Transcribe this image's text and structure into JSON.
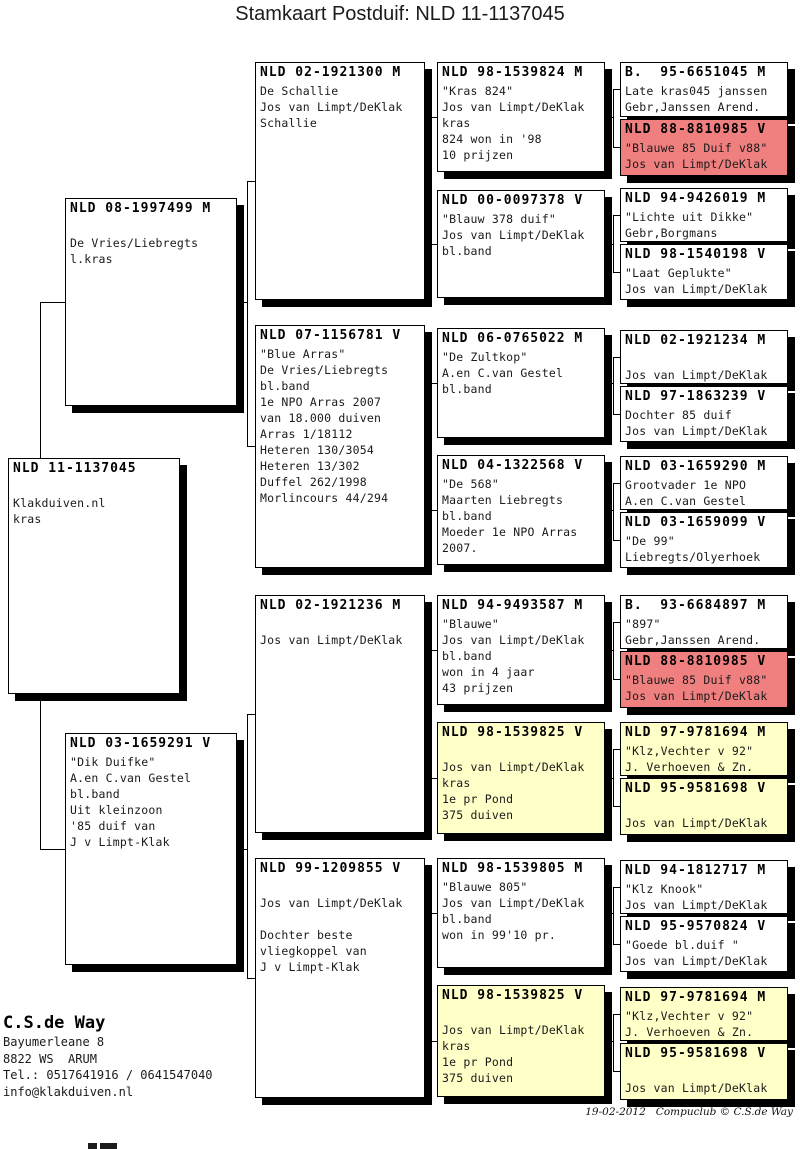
{
  "title": "Stamkaart Postduif: NLD 11-1137045",
  "colors": {
    "white": "#FFFFFF",
    "pink": "#F08080",
    "yellow": "#FFFFC8"
  },
  "footer": {
    "owner_name": "C.S.de Way",
    "address_line1": "Bayumerleane 8",
    "address_line2": "8822 WS  ARUM",
    "phone": "Tel.: 0517641916 / 0641547040",
    "email": "info@klakduiven.nl",
    "print_info": "19-02-2012   Compuclub © C.S.de Way"
  },
  "boxes": [
    {
      "id": "subject",
      "generation": 1,
      "ring": "NLD 11-1137045",
      "color": "white",
      "lines": [
        "",
        "Klakduiven.nl",
        "kras"
      ],
      "x": 8,
      "y": 458,
      "w": 172,
      "h": 236
    },
    {
      "id": "sire",
      "generation": 2,
      "ring": "NLD 08-1997499 M",
      "color": "white",
      "lines": [
        "",
        "De Vries/Liebregts",
        "l.kras"
      ],
      "x": 65,
      "y": 198,
      "w": 172,
      "h": 208
    },
    {
      "id": "dam",
      "generation": 2,
      "ring": "NLD 03-1659291 V",
      "color": "white",
      "lines": [
        "\"Dik Duifke\"",
        "A.en C.van Gestel",
        "bl.band",
        "Uit kleinzoon",
        "'85 duif van",
        "J v Limpt-Klak"
      ],
      "x": 65,
      "y": 733,
      "w": 172,
      "h": 232
    },
    {
      "id": "ss",
      "generation": 3,
      "ring": "NLD 02-1921300 M",
      "color": "white",
      "lines": [
        "De Schallie",
        "Jos van Limpt/DeKlak",
        "Schallie"
      ],
      "x": 255,
      "y": 62,
      "w": 170,
      "h": 238
    },
    {
      "id": "sd",
      "generation": 3,
      "ring": "NLD 07-1156781 V",
      "color": "white",
      "lines": [
        "\"Blue Arras\"",
        "De Vries/Liebregts",
        "bl.band",
        "1e NPO Arras 2007",
        "van 18.000 duiven",
        "Arras 1/18112",
        "Heteren 130/3054",
        "Heteren 13/302",
        "Duffel 262/1998",
        "Morlincours 44/294"
      ],
      "x": 255,
      "y": 325,
      "w": 170,
      "h": 243
    },
    {
      "id": "ds",
      "generation": 3,
      "ring": "NLD 02-1921236 M",
      "color": "white",
      "lines": [
        "",
        "Jos van Limpt/DeKlak"
      ],
      "x": 255,
      "y": 595,
      "w": 170,
      "h": 238
    },
    {
      "id": "dd",
      "generation": 3,
      "ring": "NLD 99-1209855 V",
      "color": "white",
      "lines": [
        "",
        "Jos van Limpt/DeKlak",
        "",
        "Dochter beste",
        "vliegkoppel van",
        "J v Limpt-Klak"
      ],
      "x": 255,
      "y": 858,
      "w": 170,
      "h": 240
    },
    {
      "id": "sss",
      "generation": 4,
      "ring": "NLD 98-1539824 M",
      "color": "white",
      "lines": [
        "\"Kras 824\"",
        "Jos van Limpt/DeKlak",
        "kras",
        "824 won in '98",
        "10 prijzen"
      ],
      "x": 437,
      "y": 62,
      "w": 168,
      "h": 110
    },
    {
      "id": "ssd",
      "generation": 4,
      "ring": "NLD 00-0097378 V",
      "color": "white",
      "lines": [
        "\"Blauw 378 duif\"",
        "Jos van Limpt/DeKlak",
        "bl.band"
      ],
      "x": 437,
      "y": 190,
      "w": 168,
      "h": 108
    },
    {
      "id": "sds",
      "generation": 4,
      "ring": "NLD 06-0765022 M",
      "color": "white",
      "lines": [
        "\"De Zultkop\"",
        "A.en C.van Gestel",
        "bl.band"
      ],
      "x": 437,
      "y": 328,
      "w": 168,
      "h": 110
    },
    {
      "id": "sdd",
      "generation": 4,
      "ring": "NLD 04-1322568 V",
      "color": "white",
      "lines": [
        "\"De 568\"",
        "Maarten Liebregts",
        "bl.band",
        "Moeder 1e NPO Arras",
        "2007."
      ],
      "x": 437,
      "y": 455,
      "w": 168,
      "h": 110
    },
    {
      "id": "dss",
      "generation": 4,
      "ring": "NLD 94-9493587 M",
      "color": "white",
      "lines": [
        "\"Blauwe\"",
        "Jos van Limpt/DeKlak",
        "bl.band",
        "won in 4 jaar",
        "43 prijzen"
      ],
      "x": 437,
      "y": 595,
      "w": 168,
      "h": 110
    },
    {
      "id": "dsd",
      "generation": 4,
      "ring": "NLD 98-1539825 V",
      "color": "yellow",
      "lines": [
        "",
        "Jos van Limpt/DeKlak",
        "kras",
        "1e pr Pond",
        "375 duiven"
      ],
      "x": 437,
      "y": 722,
      "w": 168,
      "h": 112
    },
    {
      "id": "dds",
      "generation": 4,
      "ring": "NLD 98-1539805 M",
      "color": "white",
      "lines": [
        "\"Blauwe 805\"",
        "Jos van Limpt/DeKlak",
        "bl.band",
        "won in 99'10 pr."
      ],
      "x": 437,
      "y": 858,
      "w": 168,
      "h": 110
    },
    {
      "id": "ddd",
      "generation": 4,
      "ring": "NLD 98-1539825 V",
      "color": "yellow",
      "lines": [
        "",
        "Jos van Limpt/DeKlak",
        "kras",
        "1e pr Pond",
        "375 duiven"
      ],
      "x": 437,
      "y": 985,
      "w": 168,
      "h": 112
    },
    {
      "id": "sss-s",
      "generation": 5,
      "ring": "B.  95-6651045 M",
      "color": "white",
      "lines": [
        "Late kras045 janssen",
        "Gebr,Janssen Arend."
      ],
      "x": 620,
      "y": 62,
      "w": 168,
      "h": 55
    },
    {
      "id": "sss-d",
      "generation": 5,
      "ring": "NLD 88-8810985 V",
      "color": "pink",
      "lines": [
        "\"Blauwe 85 Duif v88\"",
        "Jos van Limpt/DeKlak"
      ],
      "x": 620,
      "y": 119,
      "w": 168,
      "h": 57
    },
    {
      "id": "ssd-s",
      "generation": 5,
      "ring": "NLD 94-9426019 M",
      "color": "white",
      "lines": [
        "\"Lichte uit Dikke\"",
        "Gebr,Borgmans"
      ],
      "x": 620,
      "y": 188,
      "w": 168,
      "h": 54
    },
    {
      "id": "ssd-d",
      "generation": 5,
      "ring": "NLD 98-1540198 V",
      "color": "white",
      "lines": [
        "\"Laat Geplukte\"",
        "Jos van Limpt/DeKlak"
      ],
      "x": 620,
      "y": 244,
      "w": 168,
      "h": 56
    },
    {
      "id": "sds-s",
      "generation": 5,
      "ring": "NLD 02-1921234 M",
      "color": "white",
      "lines": [
        "",
        "Jos van Limpt/DeKlak"
      ],
      "x": 620,
      "y": 330,
      "w": 168,
      "h": 54
    },
    {
      "id": "sds-d",
      "generation": 5,
      "ring": "NLD 97-1863239 V",
      "color": "white",
      "lines": [
        "Dochter 85 duif",
        "Jos van Limpt/DeKlak"
      ],
      "x": 620,
      "y": 386,
      "w": 168,
      "h": 56
    },
    {
      "id": "sdd-s",
      "generation": 5,
      "ring": "NLD 03-1659290 M",
      "color": "white",
      "lines": [
        "Grootvader 1e NPO",
        "A.en C.van Gestel"
      ],
      "x": 620,
      "y": 456,
      "w": 168,
      "h": 54
    },
    {
      "id": "sdd-d",
      "generation": 5,
      "ring": "NLD 03-1659099 V",
      "color": "white",
      "lines": [
        "\"De 99\"",
        "Liebregts/Olyerhoek"
      ],
      "x": 620,
      "y": 512,
      "w": 168,
      "h": 56
    },
    {
      "id": "dss-s",
      "generation": 5,
      "ring": "B.  93-6684897 M",
      "color": "white",
      "lines": [
        "\"897\"",
        "Gebr,Janssen Arend."
      ],
      "x": 620,
      "y": 595,
      "w": 168,
      "h": 54
    },
    {
      "id": "dss-d",
      "generation": 5,
      "ring": "NLD 88-8810985 V",
      "color": "pink",
      "lines": [
        "\"Blauwe 85 Duif v88\"",
        "Jos van Limpt/DeKlak"
      ],
      "x": 620,
      "y": 651,
      "w": 168,
      "h": 57
    },
    {
      "id": "dsd-s",
      "generation": 5,
      "ring": "NLD 97-9781694 M",
      "color": "yellow",
      "lines": [
        "\"Klz,Vechter v 92\"",
        "J. Verhoeven & Zn."
      ],
      "x": 620,
      "y": 722,
      "w": 168,
      "h": 54
    },
    {
      "id": "dsd-d",
      "generation": 5,
      "ring": "NLD 95-9581698 V",
      "color": "yellow",
      "lines": [
        "",
        "Jos van Limpt/DeKlak"
      ],
      "x": 620,
      "y": 778,
      "w": 168,
      "h": 57
    },
    {
      "id": "dds-s",
      "generation": 5,
      "ring": "NLD 94-1812717 M",
      "color": "white",
      "lines": [
        "\"Klz Knook\"",
        "Jos van Limpt/DeKlak"
      ],
      "x": 620,
      "y": 860,
      "w": 168,
      "h": 54
    },
    {
      "id": "dds-d",
      "generation": 5,
      "ring": "NLD 95-9570824 V",
      "color": "white",
      "lines": [
        "\"Goede bl.duif \"",
        "Jos van Limpt/DeKlak"
      ],
      "x": 620,
      "y": 916,
      "w": 168,
      "h": 56
    },
    {
      "id": "ddd-s",
      "generation": 5,
      "ring": "NLD 97-9781694 M",
      "color": "yellow",
      "lines": [
        "\"Klz,Vechter v 92\"",
        "J. Verhoeven & Zn."
      ],
      "x": 620,
      "y": 987,
      "w": 168,
      "h": 54
    },
    {
      "id": "ddd-d",
      "generation": 5,
      "ring": "NLD 95-9581698 V",
      "color": "yellow",
      "lines": [
        "",
        "Jos van Limpt/DeKlak"
      ],
      "x": 620,
      "y": 1043,
      "w": 168,
      "h": 57
    }
  ],
  "connectors": [
    {
      "o": "v",
      "x": 40,
      "y": 302,
      "l": 547
    },
    {
      "o": "h",
      "x": 40,
      "y": 302,
      "l": 25
    },
    {
      "o": "h",
      "x": 40,
      "y": 849,
      "l": 25
    },
    {
      "o": "v",
      "x": 247,
      "y": 181,
      "l": 265
    },
    {
      "o": "h",
      "x": 247,
      "y": 181,
      "l": 8
    },
    {
      "o": "h",
      "x": 247,
      "y": 446,
      "l": 8
    },
    {
      "o": "h",
      "x": 237,
      "y": 302,
      "l": 10
    },
    {
      "o": "v",
      "x": 247,
      "y": 714,
      "l": 264
    },
    {
      "o": "h",
      "x": 247,
      "y": 714,
      "l": 8
    },
    {
      "o": "h",
      "x": 247,
      "y": 978,
      "l": 8
    },
    {
      "o": "h",
      "x": 237,
      "y": 849,
      "l": 10
    },
    {
      "o": "v",
      "x": 430,
      "y": 117,
      "l": 127
    },
    {
      "o": "h",
      "x": 430,
      "y": 117,
      "l": 7
    },
    {
      "o": "h",
      "x": 430,
      "y": 244,
      "l": 7
    },
    {
      "o": "h",
      "x": 425,
      "y": 181,
      "l": 5
    },
    {
      "o": "v",
      "x": 430,
      "y": 383,
      "l": 127
    },
    {
      "o": "h",
      "x": 430,
      "y": 383,
      "l": 7
    },
    {
      "o": "h",
      "x": 430,
      "y": 510,
      "l": 7
    },
    {
      "o": "h",
      "x": 425,
      "y": 446,
      "l": 5
    },
    {
      "o": "v",
      "x": 430,
      "y": 650,
      "l": 128
    },
    {
      "o": "h",
      "x": 430,
      "y": 650,
      "l": 7
    },
    {
      "o": "h",
      "x": 430,
      "y": 778,
      "l": 7
    },
    {
      "o": "h",
      "x": 425,
      "y": 714,
      "l": 5
    },
    {
      "o": "v",
      "x": 430,
      "y": 913,
      "l": 128
    },
    {
      "o": "h",
      "x": 430,
      "y": 913,
      "l": 7
    },
    {
      "o": "h",
      "x": 430,
      "y": 1041,
      "l": 7
    },
    {
      "o": "h",
      "x": 425,
      "y": 978,
      "l": 5
    },
    {
      "o": "v",
      "x": 613,
      "y": 89,
      "l": 58
    },
    {
      "o": "h",
      "x": 613,
      "y": 89,
      "l": 7
    },
    {
      "o": "h",
      "x": 613,
      "y": 147,
      "l": 7
    },
    {
      "o": "h",
      "x": 605,
      "y": 117,
      "l": 8
    },
    {
      "o": "v",
      "x": 613,
      "y": 215,
      "l": 57
    },
    {
      "o": "h",
      "x": 613,
      "y": 215,
      "l": 7
    },
    {
      "o": "h",
      "x": 613,
      "y": 272,
      "l": 7
    },
    {
      "o": "h",
      "x": 605,
      "y": 244,
      "l": 8
    },
    {
      "o": "v",
      "x": 613,
      "y": 357,
      "l": 57
    },
    {
      "o": "h",
      "x": 613,
      "y": 357,
      "l": 7
    },
    {
      "o": "h",
      "x": 613,
      "y": 414,
      "l": 7
    },
    {
      "o": "h",
      "x": 605,
      "y": 383,
      "l": 8
    },
    {
      "o": "v",
      "x": 613,
      "y": 483,
      "l": 57
    },
    {
      "o": "h",
      "x": 613,
      "y": 483,
      "l": 7
    },
    {
      "o": "h",
      "x": 613,
      "y": 540,
      "l": 7
    },
    {
      "o": "h",
      "x": 605,
      "y": 510,
      "l": 8
    },
    {
      "o": "v",
      "x": 613,
      "y": 622,
      "l": 57
    },
    {
      "o": "h",
      "x": 613,
      "y": 622,
      "l": 7
    },
    {
      "o": "h",
      "x": 613,
      "y": 679,
      "l": 7
    },
    {
      "o": "h",
      "x": 605,
      "y": 650,
      "l": 8
    },
    {
      "o": "v",
      "x": 613,
      "y": 749,
      "l": 57
    },
    {
      "o": "h",
      "x": 613,
      "y": 749,
      "l": 7
    },
    {
      "o": "h",
      "x": 613,
      "y": 806,
      "l": 7
    },
    {
      "o": "h",
      "x": 605,
      "y": 778,
      "l": 8
    },
    {
      "o": "v",
      "x": 613,
      "y": 887,
      "l": 57
    },
    {
      "o": "h",
      "x": 613,
      "y": 887,
      "l": 7
    },
    {
      "o": "h",
      "x": 613,
      "y": 944,
      "l": 7
    },
    {
      "o": "h",
      "x": 605,
      "y": 913,
      "l": 8
    },
    {
      "o": "v",
      "x": 613,
      "y": 1014,
      "l": 57
    },
    {
      "o": "h",
      "x": 613,
      "y": 1014,
      "l": 7
    },
    {
      "o": "h",
      "x": 613,
      "y": 1071,
      "l": 7
    },
    {
      "o": "h",
      "x": 605,
      "y": 1041,
      "l": 8
    }
  ]
}
